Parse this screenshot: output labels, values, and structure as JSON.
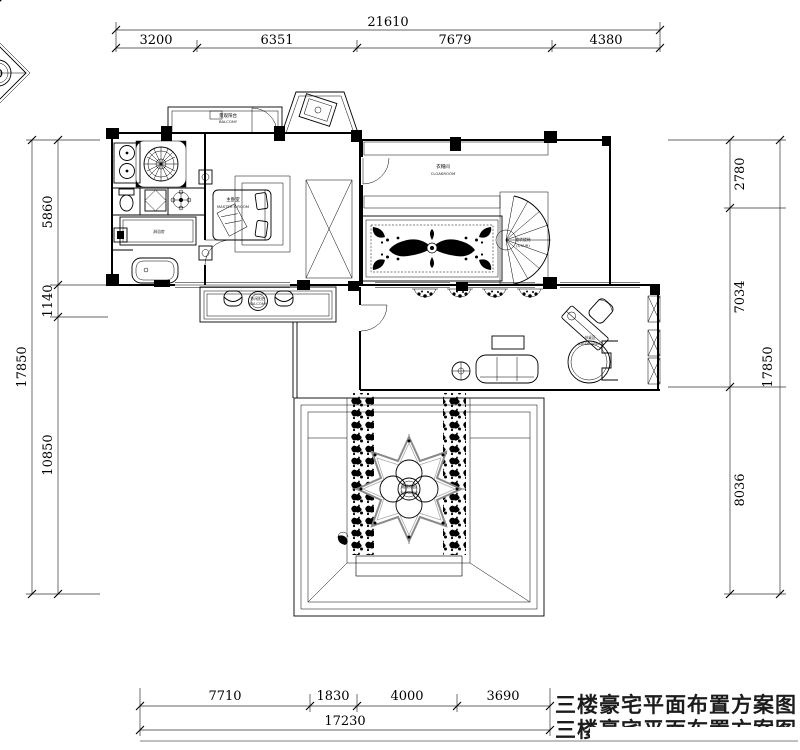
{
  "compass": {
    "letter": "D"
  },
  "dimensions": {
    "top": {
      "total": "21610",
      "segments": [
        "3200",
        "6351",
        "7679",
        "4380"
      ]
    },
    "bottom": {
      "total": "17230",
      "segments": [
        "7710",
        "1830",
        "4000",
        "3690"
      ]
    },
    "left": {
      "total": "17850",
      "segments": [
        "5860",
        "1140",
        "10850"
      ]
    },
    "right": {
      "total": "17850",
      "segments": [
        "2780",
        "7034",
        "8036"
      ]
    }
  },
  "labels": {
    "balcony_top": {
      "zh": "景观阳台",
      "en": "BALCONY"
    },
    "master_room": {
      "zh": "主卧室",
      "en": "MASTER'S ROOM"
    },
    "cloakroom": {
      "zh": "衣帽间",
      "en": "CLOAKROOM"
    },
    "stair": {
      "zh": "旋转楼梯",
      "en": "(STAIR)"
    },
    "leisure": {
      "zh": "休闲阳台",
      "en": "BALCONY"
    },
    "desk": {
      "zh": "书桌区",
      "en": "(DESK AREA)"
    },
    "garden": {
      "zh": "观景花园",
      "en": "(GARDEN)"
    },
    "bath": {
      "zh": "淋浴房"
    }
  },
  "watermark": {
    "line1": "三楼豪宅平面布置方案图",
    "line2": "三楼豪宅平面布置方案图"
  }
}
